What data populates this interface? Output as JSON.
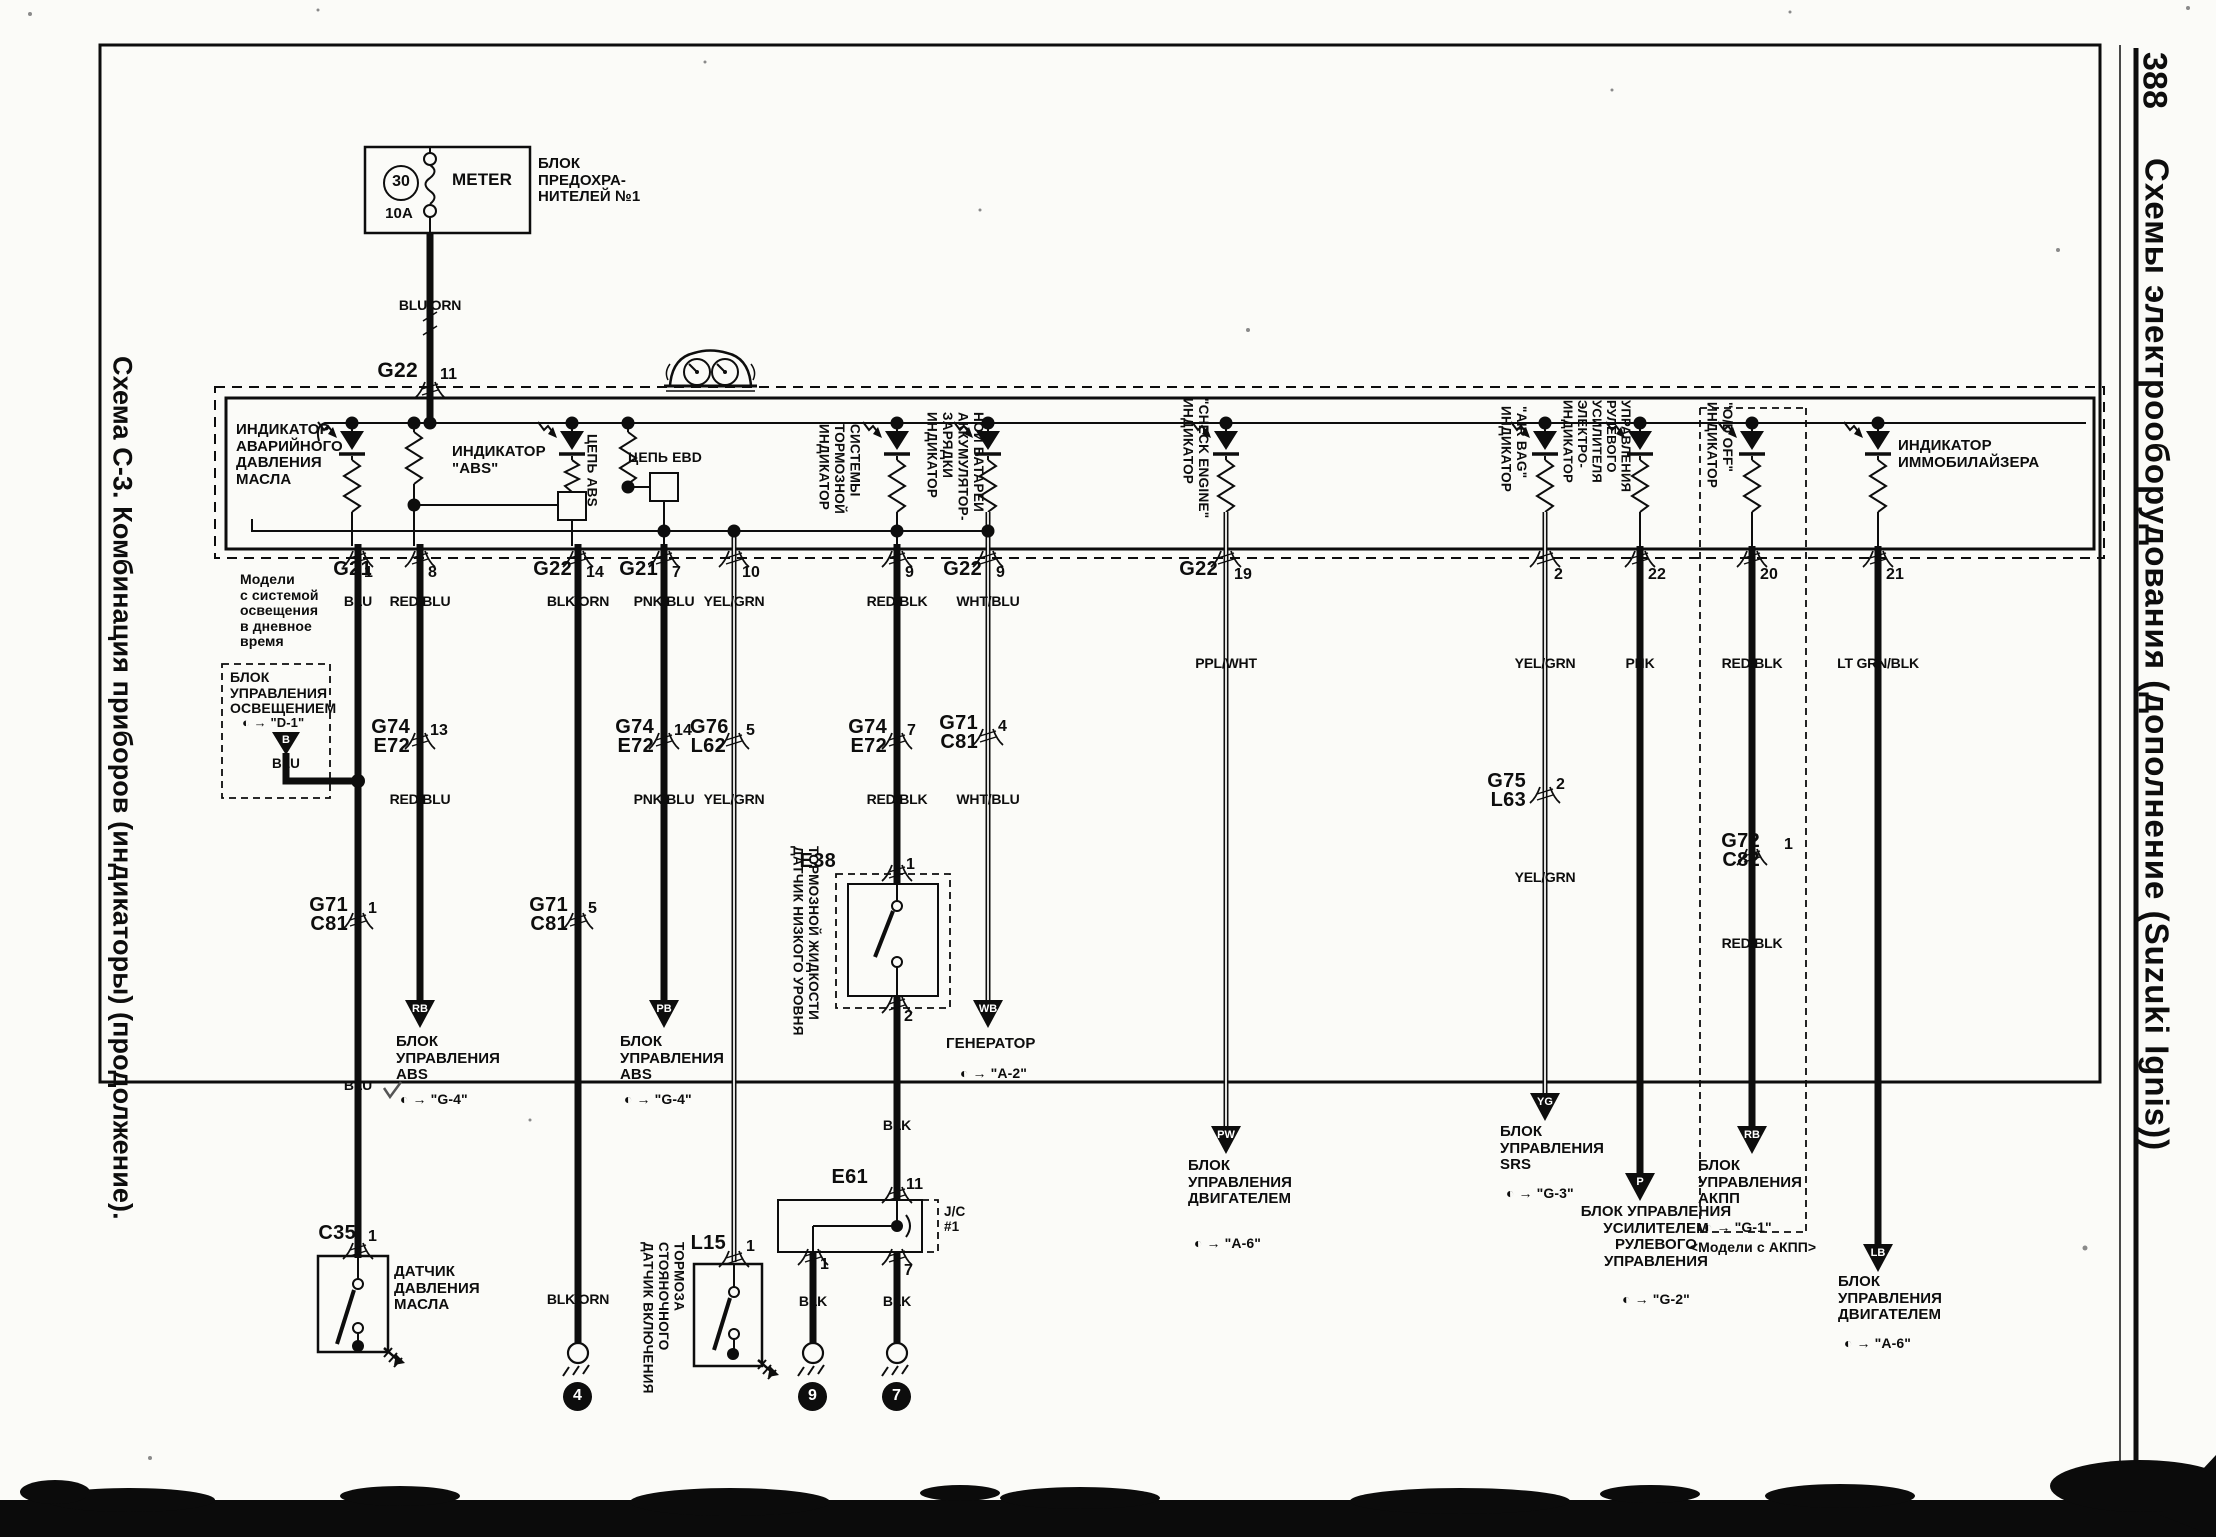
{
  "page": {
    "number": "388",
    "right_title": "Схемы электрооборудования (дополнение (Suzuki Ignis))",
    "left_title": "Схема С-3. Комбинация приборов (индикаторы) (продолжение)."
  },
  "fuse": {
    "number": "30",
    "rating": "10A",
    "name": "METER",
    "block": "БЛОК\nПРЕДОХРА-\nНИТЕЛЕЙ №1",
    "wire": "BLU/ORN",
    "conn": "G22",
    "pin": "11"
  },
  "meter": {
    "dtrl": "Модели\nс системой\nосвещения\nв дневное\nвремя",
    "oil": "ИНДИКАТОР\nАВАРИЙНОГО\nДАВЛЕНИЯ\nМАСЛА",
    "abs": "ИНДИКАТОР\n\"ABS\"",
    "abs_circuit": "ЦЕПЬ ABS",
    "ebd_circuit": "ЦЕПЬ EBD",
    "brake": "ИНДИКАТОР\nТОРМОЗНОЙ\nСИСТЕМЫ",
    "battery": "ИНДИКАТОР\nЗАРЯДКИ\nАККУМУЛЯТОР-\nНОЙ БАТАРЕИ",
    "check": "ИНДИКАТОР\n\"CHECK ENGINE\"",
    "airbag": "ИНДИКАТОР\n\"AIR BAG\"",
    "eps": "ИНДИКАТОР\nЭЛЕКТРО-\nУСИЛИТЕЛЯ\nРУЛЕВОГО\nУПРАВЛЕНИЯ",
    "od": "ИНДИКАТОР\n\"O/D OFF\"",
    "immo": "ИНДИКАТОР\nИММОБИЛАЙЗЕРА"
  },
  "pins": {
    "n1": "1",
    "g21a": "G21",
    "n8": "8",
    "g22a": "G22",
    "n14": "14",
    "g21b": "G21",
    "n7": "7",
    "n10": "10",
    "n9": "9",
    "g22b": "G22",
    "n9b": "9",
    "g22c": "G22",
    "n19": "19",
    "n2": "2",
    "n22": "22",
    "n20": "20",
    "n21": "21"
  },
  "wires": {
    "w1": {
      "c1": "BLU",
      "c2": "BLU",
      "conn": "G71\nC81",
      "pin": "1"
    },
    "w2": {
      "c1": "RED/BLU",
      "c2": "RED/BLU",
      "conn": "G74\nE72",
      "pin": "13",
      "code": "RB",
      "dest": "БЛОК\nУПРАВЛЕНИЯ\nABS",
      "ref": "◐ →  \"G-4\""
    },
    "w3": {
      "c1": "BLK/ORN",
      "c2": "BLK/ORN",
      "conn": "G71\nC81",
      "pin": "5",
      "gnum": "4"
    },
    "w4": {
      "c1": "PNK/BLU",
      "c2": "PNK/BLU",
      "conn": "G74\nE72",
      "pin": "14",
      "code": "PB",
      "dest": "БЛОК\nУПРАВЛЕНИЯ\nABS",
      "ref": "◐ →  \"G-4\""
    },
    "w5": {
      "c1": "YEL/GRN",
      "c2": "YEL/GRN",
      "conn": "G76\nL62",
      "pin": "5"
    },
    "w6": {
      "c1": "RED/BLK",
      "c2": "RED/BLK",
      "conn": "G74\nE72",
      "pin": "7",
      "c3": "BLK"
    },
    "w7": {
      "c1": "WHT/BLU",
      "c2": "WHT/BLU",
      "conn": "G71\nC81",
      "pin": "4",
      "code": "WB",
      "dest": "ГЕНЕРАТОР",
      "ref": "◐ →  \"A-2\""
    },
    "w8": {
      "c1": "PPL/WHT",
      "code": "PW",
      "dest": "БЛОК\nУПРАВЛЕНИЯ\nДВИГАТЕЛЕМ",
      "ref": "◐ →  \"A-6\""
    },
    "w9": {
      "c1": "YEL/GRN",
      "c2": "YEL/GRN",
      "conn": "G75\nL63",
      "pin": "2",
      "code": "YG",
      "dest": "БЛОК\nУПРАВЛЕНИЯ\nSRS",
      "ref": "◐ →  \"G-3\""
    },
    "w10": {
      "c1": "PNK",
      "code": "P",
      "dest": "БЛОК УПРАВЛЕНИЯ\nУСИЛИТЕЛЕМ\nРУЛЕВОГО\nУПРАВЛЕНИЯ",
      "ref": "◐ →  \"G-2\""
    },
    "w11": {
      "c1": "RED/BLK",
      "c2": "RED/BLK",
      "conn": "G72\nC82",
      "pin": "1",
      "code": "RB",
      "dest": "БЛОК\nУПРАВЛЕНИЯ\nАКПП",
      "ref": "◐ →  \"G-1\"",
      "note": "<Модели с АКПП>"
    },
    "w12": {
      "c1": "LT GRN/BLK",
      "code": "LB",
      "dest": "БЛОК\nУПРАВЛЕНИЯ\nДВИГАТЕЛЕМ",
      "ref": "◐ →  \"A-6\""
    }
  },
  "lighting": {
    "title": "БЛОК\nУПРАВЛЕНИЯ\nОСВЕЩЕНИЕМ",
    "ref": "◐ →  \"D-1\"",
    "code": "B",
    "wire": "BLU"
  },
  "devices": {
    "c35": {
      "conn": "C35",
      "pin": "1",
      "name": "ДАТЧИК\nДАВЛЕНИЯ\nМАСЛА"
    },
    "l15": {
      "conn": "L15",
      "pin": "1",
      "name": "ДАТЧИК ВКЛЮЧЕНИЯ\nСТОЯНОЧНОГО\nТОРМОЗА"
    },
    "e38": {
      "conn": "E38",
      "pin_top": "1",
      "pin_bot": "2",
      "name": "ДАТЧИК НИЗКОГО УРОВНЯ\nТОРМОЗНОЙ ЖИДКОСТИ"
    },
    "e61": {
      "conn": "E61",
      "pin": "11",
      "jc": "J/C\n#1",
      "out1": "1",
      "out2": "7",
      "c1": "BLK",
      "c2": "BLK",
      "g1": "9",
      "g2": "7"
    }
  }
}
